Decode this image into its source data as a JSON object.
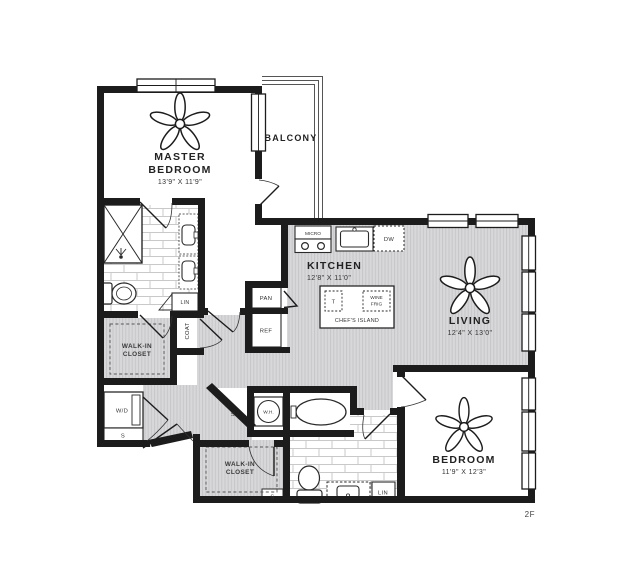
{
  "plan": {
    "type": "apartment-floor-plan",
    "floor_tag": "2F",
    "colors": {
      "wall": "#1c1c1c",
      "floor_gray": "#d8d8da",
      "floor_stripe": "#c6c6c9",
      "tile_line": "#c9c9c9",
      "background": "#ffffff"
    },
    "labels": {
      "master_line1": "MASTER",
      "master_line2": "BEDROOM",
      "master_dims": "13'9\" X 11'9\"",
      "balcony": "BALCONY",
      "kitchen": "KITCHEN",
      "kitchen_dims": "12'8\" X 11'0\"",
      "living": "LIVING",
      "living_dims": "12'4\" X 13'0\"",
      "bedroom": "BEDROOM",
      "bedroom_dims": "11'9\" X 12'3\"",
      "walk_in_line1": "WALK-IN",
      "walk_in_line2": "CLOSET",
      "coat": "COAT",
      "lin": "LIN",
      "pan": "PAN",
      "ref": "REF",
      "micro": "MICRO",
      "dw": "DW",
      "wine_line1": "WINE",
      "wine_line2": "FRIG",
      "island": "CHEF'S ISLAND",
      "trash": "T",
      "wd": "W/D",
      "wh": "W.H.",
      "shelf": "S",
      "floor_tag": "2F"
    }
  }
}
